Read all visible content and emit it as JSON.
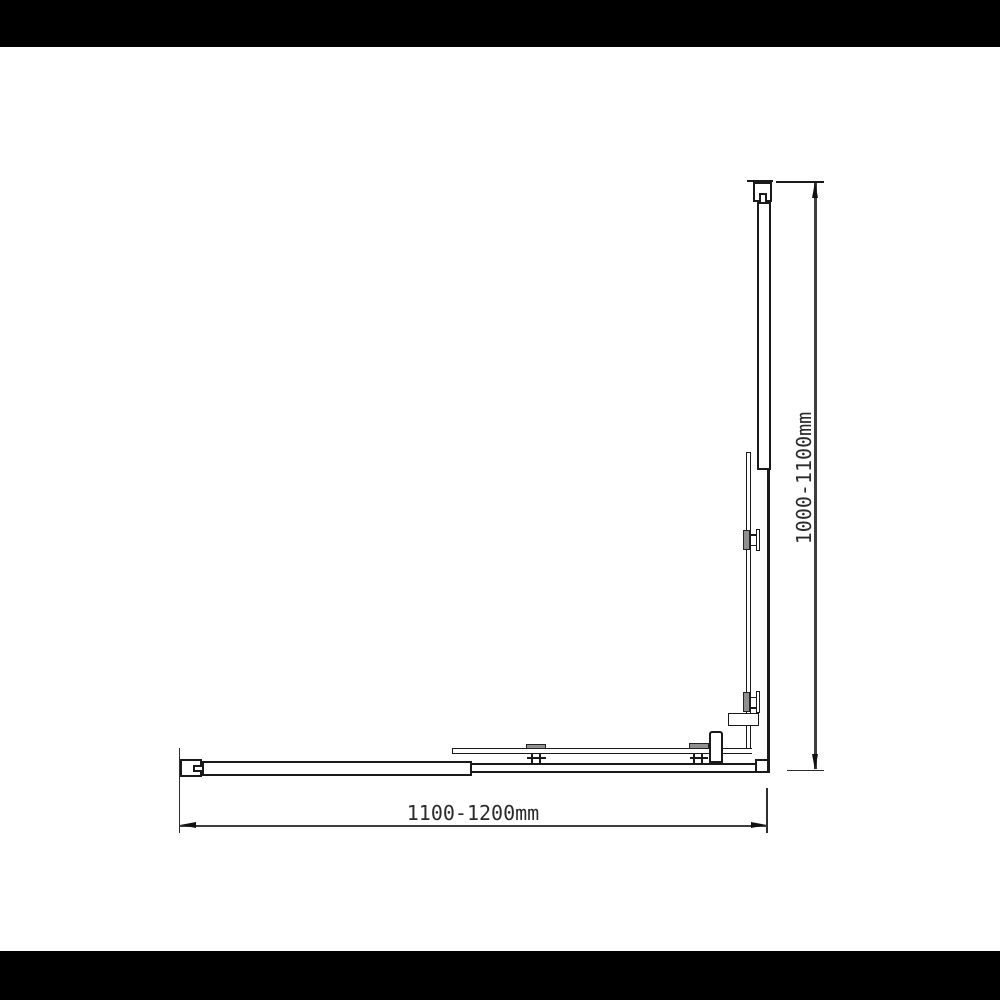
{
  "diagram": {
    "description_labels": {
      "width_dimension": "1100-1200mm",
      "height_dimension": "1000-1100mm"
    }
  },
  "colors": {
    "bg": "#000000",
    "canvas": "#ffffff",
    "line": "#1a1a1a",
    "dim": "#3d3d3d",
    "ext": "#2e2e2e",
    "clamp": "#8f8f8f",
    "text": "#2b2b2b"
  }
}
